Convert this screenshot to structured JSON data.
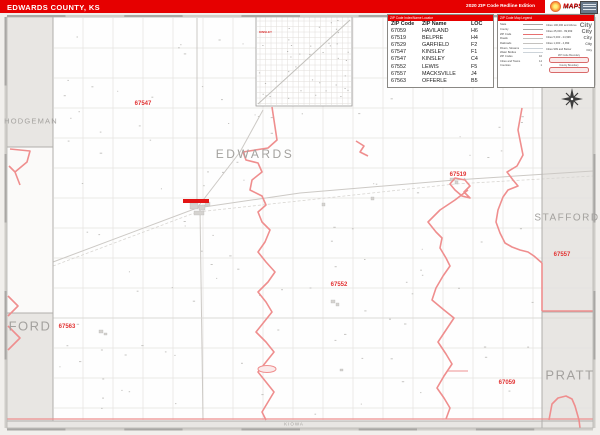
{
  "header": {
    "title": "EDWARDS COUNTY, KS",
    "edition": "2020 ZIP Code Redline Edition",
    "logo_text": "MAPS"
  },
  "zip_index": {
    "title": "ZIP Code Index/Name Locator",
    "columns": [
      "ZIP Code",
      "ZIP Name",
      "LOC"
    ],
    "rows": [
      {
        "zip": "67059",
        "name": "HAVILAND",
        "loc": "H6"
      },
      {
        "zip": "67519",
        "name": "BELPRE",
        "loc": "H4"
      },
      {
        "zip": "67529",
        "name": "GARFIELD",
        "loc": "F2"
      },
      {
        "zip": "67547",
        "name": "KINSLEY",
        "loc": "F1"
      },
      {
        "zip": "67547",
        "name": "KINSLEY",
        "loc": "C4"
      },
      {
        "zip": "67552",
        "name": "LEWIS",
        "loc": "F5"
      },
      {
        "zip": "67557",
        "name": "MACKSVILLE",
        "loc": "J4"
      },
      {
        "zip": "67563",
        "name": "OFFERLE",
        "loc": "B5"
      }
    ]
  },
  "legend": {
    "title": "ZIP Code Map Legend",
    "line_items": [
      {
        "label": "State",
        "color": "#a8a6a3"
      },
      {
        "label": "County",
        "color": "#a8a6a3"
      },
      {
        "label": "ZIP Code",
        "color": "#e87070"
      },
      {
        "label": "Roads",
        "color": "#c4c2bf"
      },
      {
        "label": "Railroads",
        "color": "#c4c2bf"
      },
      {
        "label": "Rivers, Streams",
        "color": "#cdd4da"
      },
      {
        "label": "Water Bodies",
        "color": "#cdd4da"
      }
    ],
    "stat_items": [
      {
        "label": "ZIP Codes",
        "value": "10"
      },
      {
        "label": "Cities and Towns",
        "value": "14"
      },
      {
        "label": "Counties",
        "value": "1"
      }
    ],
    "city_classes": [
      {
        "label": "Cities 100,000 and Above",
        "sample": "City",
        "size": 6.5
      },
      {
        "label": "Cities 25,000 - 99,999",
        "sample": "City",
        "size": 5.5
      },
      {
        "label": "Cities 5,000 - 24,999",
        "sample": "City",
        "size": 4.5
      },
      {
        "label": "Cities 1,000 - 4,999",
        "sample": "City",
        "size": 3.6
      },
      {
        "label": "Cities 999 and Below",
        "sample": "City",
        "size": 3.0
      }
    ],
    "boundary_samples": [
      {
        "label": "ZIP Code Boundary"
      },
      {
        "label": "County Boundary"
      }
    ]
  },
  "map": {
    "county_labels": [
      {
        "id": "hodgeman",
        "text": "HODGEMAN",
        "x": 31,
        "y": 121,
        "size": 7.5,
        "spacing": 1.2
      },
      {
        "id": "edwards",
        "text": "EDWARDS",
        "x": 255,
        "y": 154,
        "size": 12,
        "spacing": 2.5
      },
      {
        "id": "stafford",
        "text": "STAFFORD",
        "x": 567,
        "y": 218,
        "size": 10,
        "spacing": 1.5
      },
      {
        "id": "ford",
        "text": "FORD",
        "x": 30,
        "y": 326,
        "size": 13,
        "spacing": 1.5
      },
      {
        "id": "pratt",
        "text": "PRATT",
        "x": 570,
        "y": 375,
        "size": 13,
        "spacing": 1.5
      },
      {
        "id": "kiowa",
        "text": "KIOWA",
        "x": 294,
        "y": 424,
        "size": 4.5,
        "spacing": 1
      }
    ],
    "zip_labels": [
      {
        "text": "67547",
        "x": 143,
        "y": 104
      },
      {
        "text": "67519",
        "x": 458,
        "y": 175
      },
      {
        "text": "67557",
        "x": 562,
        "y": 255
      },
      {
        "text": "67552",
        "x": 339,
        "y": 285
      },
      {
        "text": "67563",
        "x": 67,
        "y": 327
      },
      {
        "text": "67059",
        "x": 507,
        "y": 383
      }
    ],
    "inset_label": "KINSLEY"
  }
}
